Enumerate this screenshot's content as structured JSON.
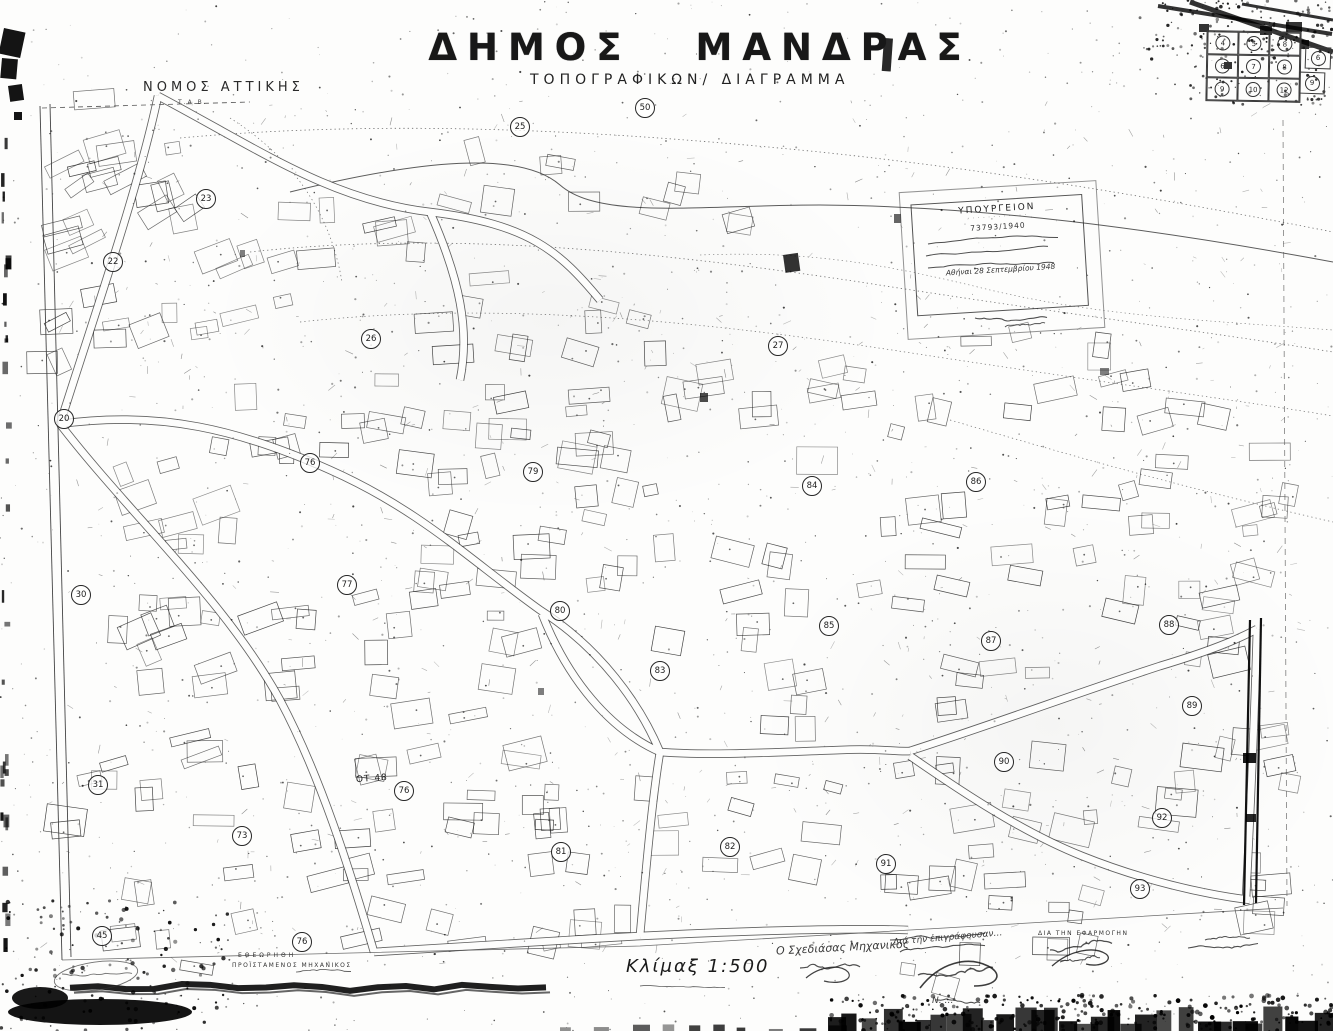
{
  "header": {
    "region": "ΝΟΜΟΣ ΑΤΤΙΚΗΣ",
    "region_sub": "Τ.Α.Β.",
    "title_word1": "ΔΗΜΟΣ",
    "title_word2": "ΜΑΝΔΡΑΣ",
    "subtitle": "ΤΟΠΟΓΡΑΦΙΚΩΝ/   ΔΙΑΓΡΑΜΜΑ"
  },
  "stamp": {
    "header": "ΥΠΟΥΡΓΕΙΟΝ",
    "sub_dots": "· · · · · · · · · · · ·",
    "ref_number": "73793/1940",
    "date_line": "Αθήναι 28 Σεπτεμβρίου 1948"
  },
  "scale": {
    "label": "Κλίμαξ 1:500"
  },
  "annotations": {
    "ot_label": "ΟΤ 48"
  },
  "footer": {
    "review_stamp_line1": "ΕΘΕΩΡΗΘΗ",
    "review_stamp_line2": "ΠΡΟΪΣΤΑΜΕΝΟΣ ΜΗΧΑΝΙΚΟΣ",
    "drafter_caption": "Ο Σχεδιάσας Μηχανικός",
    "certify_caption": "Διά τήν ἐπιγράφουσαν…",
    "approval_caption": "ΔΙΑ ΤΗΝ ΕΦΑΡΜΟΓΗΝ",
    "signer_name": "Ν. …"
  },
  "index_grid": {
    "rows": [
      [
        "4",
        "5",
        "8"
      ],
      [
        "6",
        "7",
        "8"
      ],
      [
        "9",
        "10",
        "12"
      ]
    ],
    "side": [
      "6",
      "9"
    ]
  },
  "blocks": [
    {
      "label": "23",
      "x": 206,
      "y": 199
    },
    {
      "label": "22",
      "x": 113,
      "y": 262
    },
    {
      "label": "25",
      "x": 520,
      "y": 127
    },
    {
      "label": "50",
      "x": 645,
      "y": 108
    },
    {
      "label": "20",
      "x": 64,
      "y": 419
    },
    {
      "label": "26",
      "x": 371,
      "y": 339
    },
    {
      "label": "27",
      "x": 778,
      "y": 346
    },
    {
      "label": "76",
      "x": 310,
      "y": 463
    },
    {
      "label": "79",
      "x": 533,
      "y": 472
    },
    {
      "label": "84",
      "x": 812,
      "y": 486
    },
    {
      "label": "86",
      "x": 976,
      "y": 482
    },
    {
      "label": "30",
      "x": 81,
      "y": 595
    },
    {
      "label": "77",
      "x": 347,
      "y": 585
    },
    {
      "label": "80",
      "x": 560,
      "y": 611
    },
    {
      "label": "85",
      "x": 829,
      "y": 626
    },
    {
      "label": "87",
      "x": 991,
      "y": 641
    },
    {
      "label": "88",
      "x": 1169,
      "y": 625
    },
    {
      "label": "83",
      "x": 660,
      "y": 671
    },
    {
      "label": "89",
      "x": 1192,
      "y": 706
    },
    {
      "label": "31",
      "x": 98,
      "y": 785
    },
    {
      "label": "76",
      "x": 404,
      "y": 791
    },
    {
      "label": "73",
      "x": 242,
      "y": 836
    },
    {
      "label": "81",
      "x": 561,
      "y": 852
    },
    {
      "label": "82",
      "x": 730,
      "y": 847
    },
    {
      "label": "90",
      "x": 1004,
      "y": 762
    },
    {
      "label": "91",
      "x": 886,
      "y": 864
    },
    {
      "label": "92",
      "x": 1162,
      "y": 818
    },
    {
      "label": "93",
      "x": 1140,
      "y": 889
    },
    {
      "label": "45",
      "x": 102,
      "y": 936
    },
    {
      "label": "76",
      "x": 302,
      "y": 942
    }
  ],
  "ot_pos": {
    "x": 356,
    "y": 774
  }
}
